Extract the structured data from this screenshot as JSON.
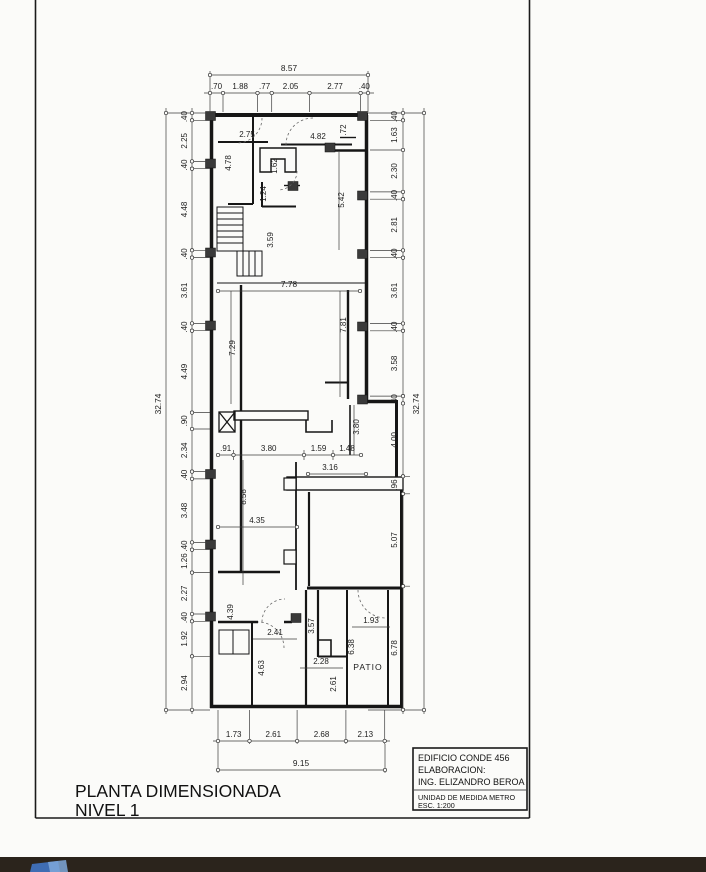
{
  "colors": {
    "paper": "#fbfbf9",
    "ink": "#1a1a1a",
    "thin_line": "#3c3c3c",
    "column_fill": "#3a3a3a",
    "taskbar": "#2b241c",
    "logo_blue_dark": "#3f6db3",
    "logo_blue_light": "#7fa8d9"
  },
  "title": {
    "line1": "PLANTA DIMENSIONADA",
    "line2": "NIVEL 1"
  },
  "title_block": {
    "building": "EDIFICIO CONDE 456",
    "elaboration_label": "ELABORACION:",
    "engineer": "ING. ELIZANDRO BEROA",
    "unit": "UNIDAD DE MEDIDA METRO",
    "scale": "ESC. 1:200"
  },
  "plan": {
    "patio_label": "PATIO",
    "dims": {
      "top": {
        "overall": "8.57",
        "segments": [
          ".70",
          "1.88",
          ".77",
          "2.05",
          "2.77",
          ".40"
        ]
      },
      "left": {
        "overall": "32.74",
        "segments": [
          ".40",
          "2.25",
          ".40",
          "4.48",
          ".40",
          "3.61",
          ".40",
          "4.49",
          ".90",
          "2.34",
          ".40",
          "3.48",
          ".40",
          "1.26",
          "2.27",
          ".40",
          "1.92",
          "2.94"
        ]
      },
      "right": {
        "overall": "32.74",
        "segments": [
          ".40",
          "1.63",
          "2.30",
          ".40",
          "2.81",
          ".40",
          "3.61",
          ".40",
          "3.58",
          ".40",
          "4.00",
          ".96",
          "5.07",
          "6.78"
        ]
      },
      "bottom": {
        "overall": "9.15",
        "segments": [
          "1.73",
          "2.61",
          "2.68",
          "2.13"
        ]
      },
      "interior": {
        "top_left_room_w": "2.75",
        "top_right_room_w": "4.82",
        "top_right_niche": ".72",
        "left_room_h": "4.78",
        "closet_w": "1.62",
        "closet_h": "1.24",
        "corridor_h": "5.42",
        "stair_h": "3.59",
        "hall_w": "7.78",
        "hall_h_left": "7.29",
        "hall_h_right": "7.81",
        "niche_h": "3.80",
        "row_seg1": ".91",
        "row_seg2": "3.80",
        "row_seg3": "1.59",
        "row_seg4": "1.48",
        "rear_w": "3.16",
        "mid_room_h": "8.58",
        "mid_room_w": "4.35",
        "corridor2_h": "4.39",
        "bath_w": "2.41",
        "corridor3_h": "3.57",
        "patio_door_w": "1.93",
        "room_463_h": "4.63",
        "room_228_w": "2.28",
        "room_261_h": "2.61",
        "patio_strip_h": "6.38"
      }
    }
  }
}
